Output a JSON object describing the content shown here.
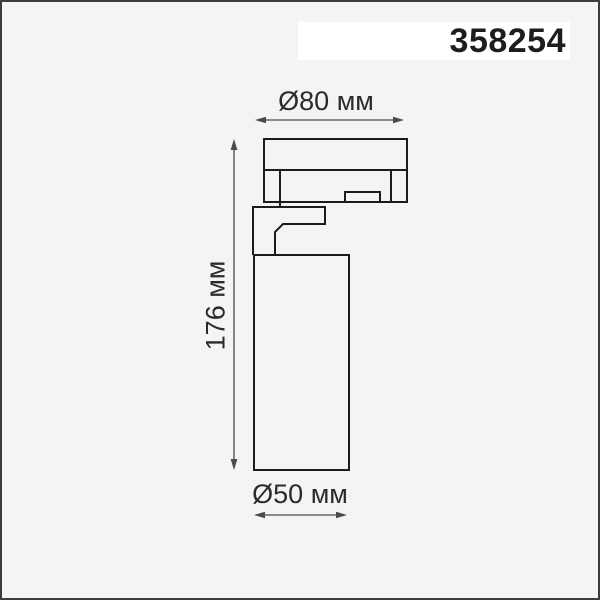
{
  "product": {
    "code": "358254"
  },
  "drawing": {
    "dimensions": {
      "top_diameter": {
        "label": "Ø80 мм",
        "value_mm": 80
      },
      "height": {
        "label": "176 мм",
        "value_mm": 176
      },
      "bottom_diameter": {
        "label": "Ø50 мм",
        "value_mm": 50
      }
    },
    "colors": {
      "outline": "#1c1c1c",
      "dimension_line": "#4a4a4a",
      "background": "#f4f4f4",
      "code_panel": "#ffffff"
    }
  }
}
